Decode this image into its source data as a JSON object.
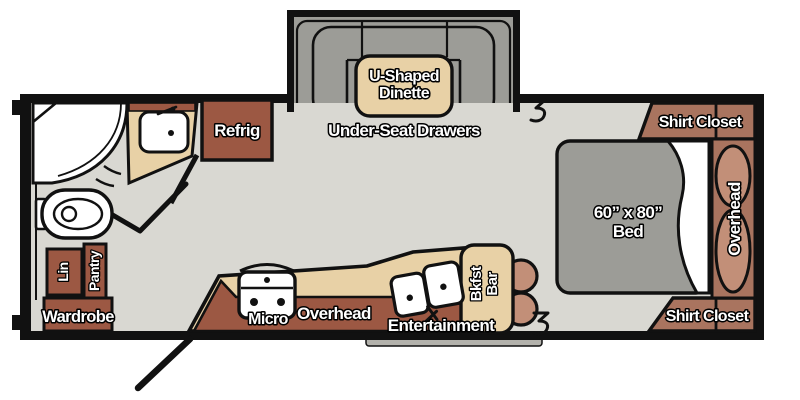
{
  "title": "Travel Trailer Floor Plan",
  "colors": {
    "floor": "#d9d8d2",
    "cushion_gray": "#9c9c97",
    "counter_tan": "#e8d1a6",
    "cabinet_brick": "#9c5843",
    "closet_rosy": "#a9745f",
    "pillow_salmon": "#c28f78",
    "wall_black": "#111111",
    "fixture_white": "#ffffff",
    "step_gray": "#b3b2ac"
  },
  "labels": {
    "dinette_line1": "U-Shaped",
    "dinette_line2": "Dinette",
    "under_seat": "Under-Seat Drawers",
    "refrig": "Refrig",
    "shirt_closet_top": "Shirt Closet",
    "shirt_closet_bottom": "Shirt Closet",
    "bed_size": "60” x 80”",
    "bed": "Bed",
    "overhead_bed": "Overhead",
    "lin": "Lin",
    "pantry": "Pantry",
    "wardrobe": "Wardrobe",
    "micro": "Micro",
    "overhead_kitchen": "Overhead",
    "entertainment": "Entertainment",
    "bkfst_line1": "Bkfst",
    "bkfst_line2": "Bar"
  }
}
